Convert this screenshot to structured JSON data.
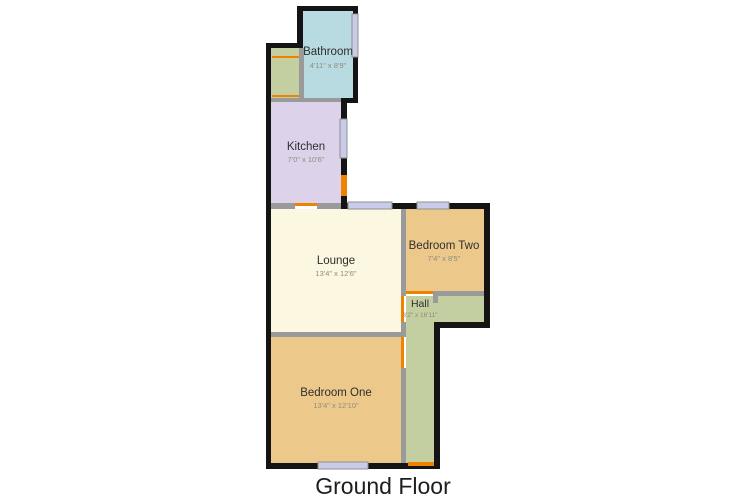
{
  "floor_label": "Ground Floor",
  "colors": {
    "wall": "#141414",
    "inner_wall": "#9a9a9a",
    "door": "#ef8200",
    "window_fill": "#c9cce9",
    "bathroom": "#b7dbe1",
    "kitchen": "#dcd3eb",
    "lounge": "#fbf7e1",
    "bedroom": "#ecc98b",
    "hall": "#c3cfa0"
  },
  "rooms": {
    "bathroom": {
      "name": "Bathroom",
      "dims": "4'11\" x 8'9\""
    },
    "kitchen": {
      "name": "Kitchen",
      "dims": "7'0\" x 10'6\""
    },
    "lounge": {
      "name": "Lounge",
      "dims": "13'4\" x 12'6\""
    },
    "bedroom_two": {
      "name": "Bedroom Two",
      "dims": "7'4\" x 8'5\""
    },
    "hall": {
      "name": "Hall",
      "dims": "3'2\" x 16'11\""
    },
    "bedroom_one": {
      "name": "Bedroom One",
      "dims": "13'4\" x 12'10\""
    }
  }
}
